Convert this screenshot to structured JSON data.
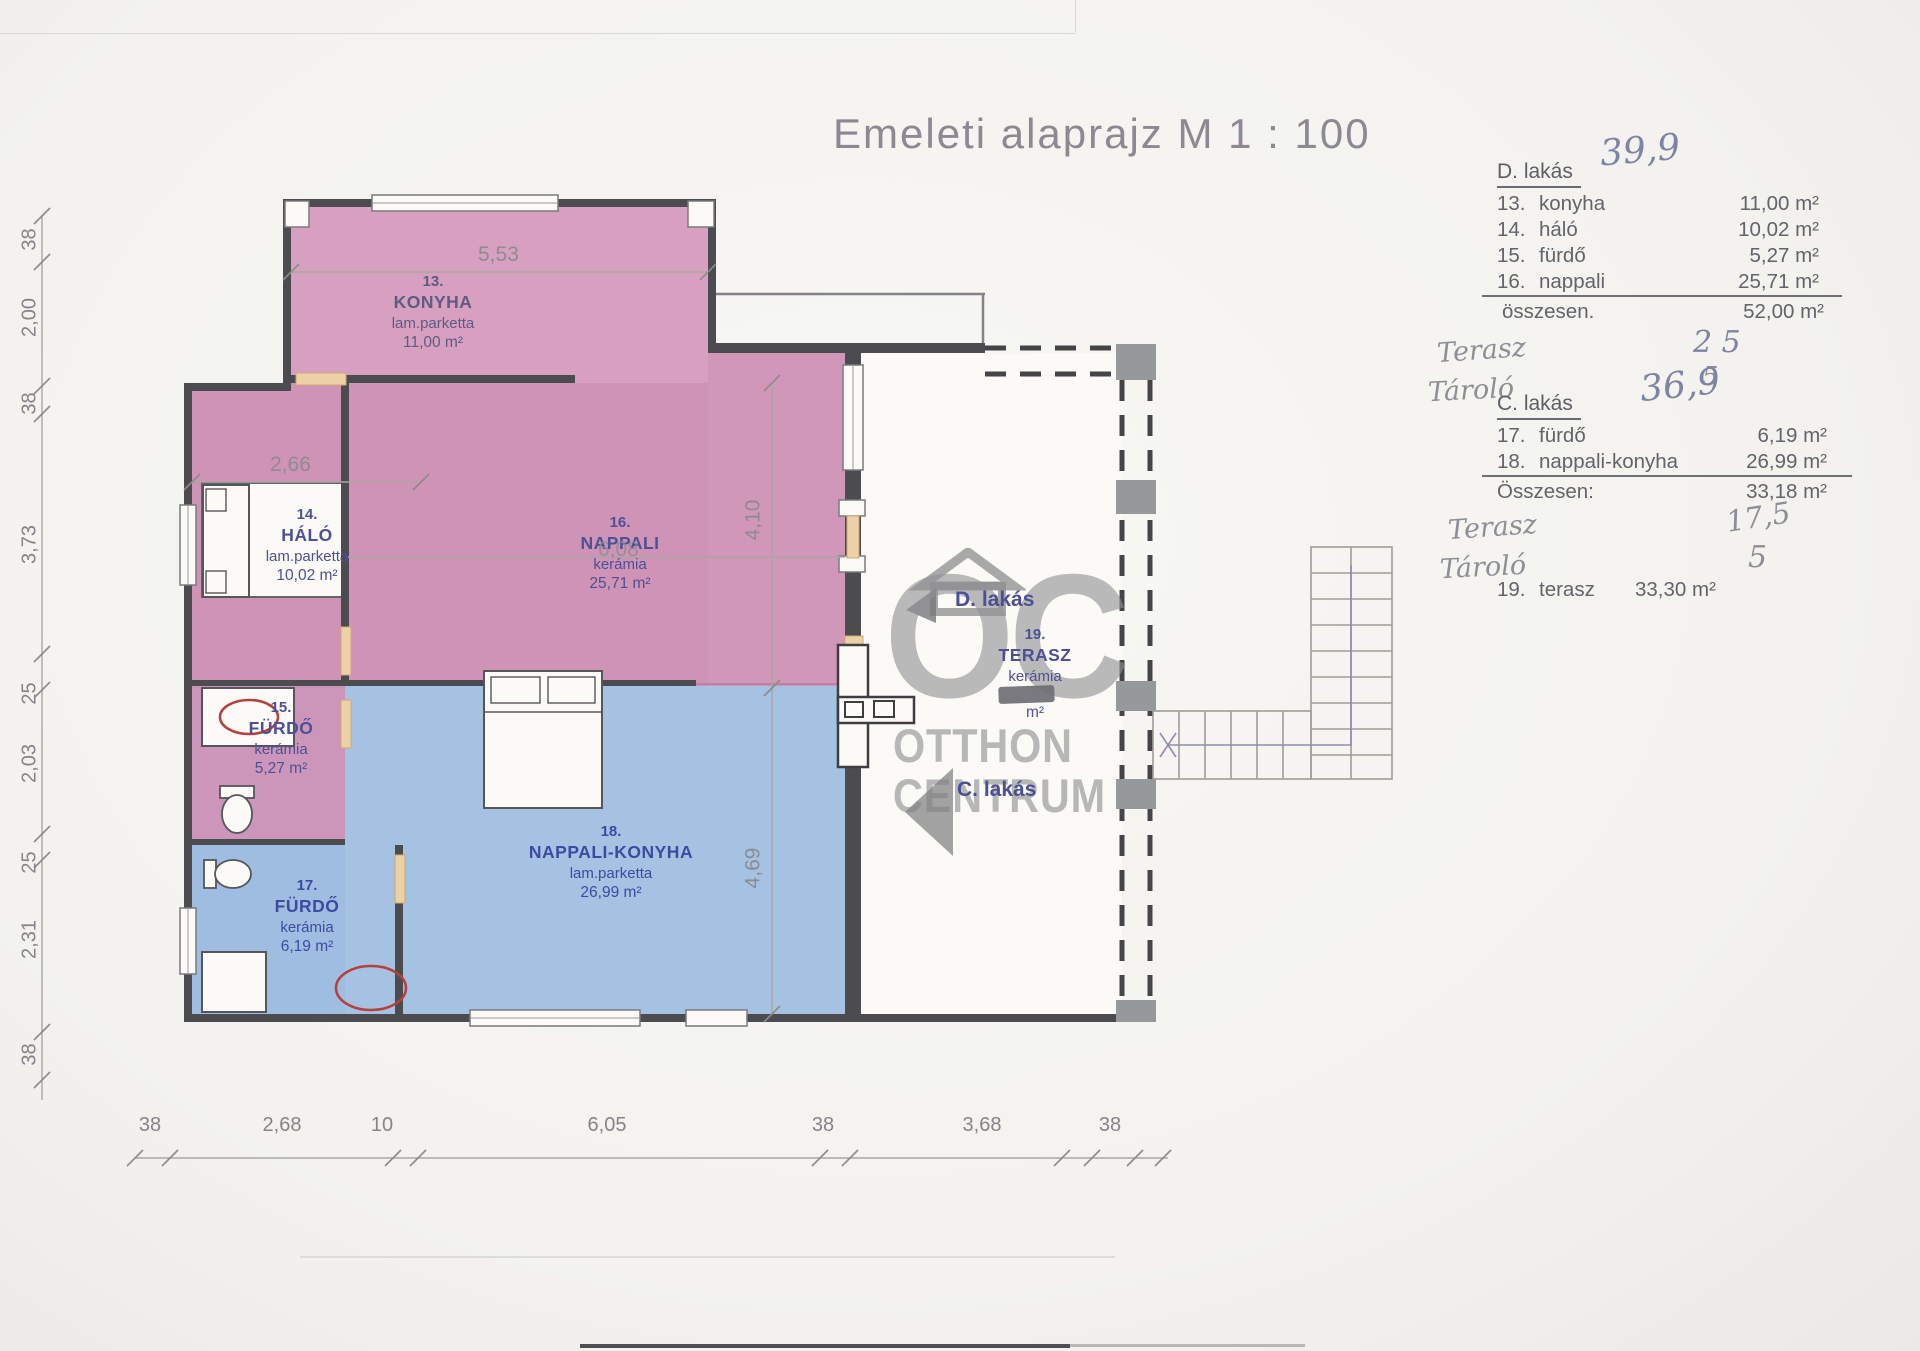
{
  "title": "Emeleti alaprajz M 1 : 100",
  "watermark": {
    "oc": "OC",
    "line1": "OTTHON",
    "line2": "CENTRUM"
  },
  "unit_labels": {
    "d": "D. lakás",
    "c": "C. lakás"
  },
  "legend_d": {
    "heading": "D. lakás",
    "handwritten_total": "39,9",
    "rows": [
      {
        "num": "13.",
        "name": "konyha",
        "area": "11,00 m²"
      },
      {
        "num": "14.",
        "name": "háló",
        "area": "10,02 m²"
      },
      {
        "num": "15.",
        "name": "fürdő",
        "area": "5,27 m²"
      },
      {
        "num": "16.",
        "name": "nappali",
        "area": "25,71 m²"
      }
    ],
    "total_label": "összesen.",
    "total_value": "52,00 m²",
    "hand_terasz_label": "Terasz",
    "hand_terasz_value": "2 5",
    "hand_tarolo_label": "Tároló",
    "hand_tarolo_value": "5"
  },
  "legend_c": {
    "heading": "C. lakás",
    "handwritten_total": "36,9",
    "rows": [
      {
        "num": "17.",
        "name": "fürdő",
        "area": "6,19 m²"
      },
      {
        "num": "18.",
        "name": "nappali-konyha",
        "area": "26,99 m²"
      }
    ],
    "total_label": "Összesen:",
    "total_value": "33,18 m²",
    "hand_terasz_label": "Terasz",
    "hand_terasz_value": "17,5",
    "hand_tarolo_label": "Tároló",
    "hand_tarolo_value": "5",
    "terasz_row": {
      "num": "19.",
      "name": "terasz",
      "area": "33,30 m²"
    }
  },
  "rooms": [
    {
      "num": "13.",
      "name": "KONYHA",
      "floor": "lam.parketta",
      "area": "11,00 m²"
    },
    {
      "num": "14.",
      "name": "HÁLÓ",
      "floor": "lam.parketta",
      "area": "10,02 m²"
    },
    {
      "num": "15.",
      "name": "FÜRDŐ",
      "floor": "kerámia",
      "area": "5,27 m²"
    },
    {
      "num": "16.",
      "name": "NAPPALI",
      "floor": "kerámia",
      "area": "25,71 m²"
    },
    {
      "num": "17.",
      "name": "FÜRDŐ",
      "floor": "kerámia",
      "area": "6,19 m²"
    },
    {
      "num": "18.",
      "name": "NAPPALI-KONYHA",
      "floor": "lam.parketta",
      "area": "26,99 m²"
    },
    {
      "num": "19.",
      "name": "TERASZ",
      "floor": "kerámia",
      "area_suffix": "m²"
    }
  ],
  "dims": {
    "left": [
      "38",
      "2,00",
      "38",
      "3,73",
      "25",
      "2,03",
      "25",
      "2,31",
      "38"
    ],
    "bottom": [
      "38",
      "2,68",
      "10",
      "6,05",
      "38",
      "3,68",
      "38"
    ],
    "plan": {
      "konyha_w": "5,53",
      "halo_w": "2,66",
      "nappali_w": "6,08",
      "terasz_h": "4,10",
      "nk_h": "4,69"
    }
  },
  "colors": {
    "pink": "#d59bbc",
    "pink_dark": "#cf93b6",
    "blue": "#a5c2e3",
    "blue_dark": "#9fbde0",
    "wall": "#4c4b4f",
    "accent_label": "#3c4aa2",
    "fixture_red": "#b5413c",
    "door_tan": "#ecd0a6"
  }
}
